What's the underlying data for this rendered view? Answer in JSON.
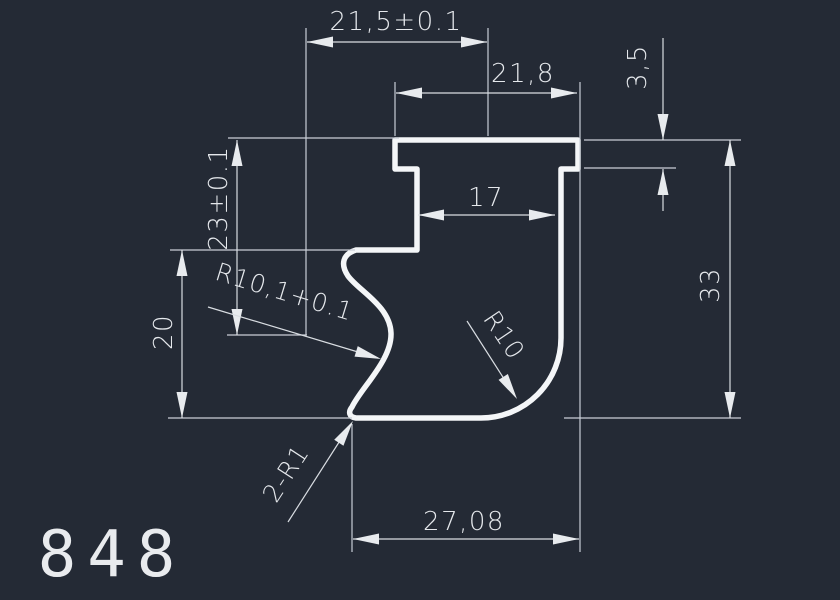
{
  "drawing": {
    "part_number": "848",
    "colors": {
      "background": "#242a35",
      "profile_line": "#f4f6f8",
      "dimension_line": "#d9dde2",
      "text": "#e5e8ec"
    },
    "dimensions": {
      "top_width": "21,5±0.1",
      "flange_width": "21,8",
      "flange_thickness": "3,5",
      "height_to_arc_center": "23±0.1",
      "lower_left_height": "20",
      "inner_width": "17",
      "total_height": "33",
      "bottom_width": "27,08",
      "left_arc_radius": "R10,1+0.1",
      "bottom_fillet_radius": "R10",
      "notch_radii": "2-R1"
    }
  }
}
